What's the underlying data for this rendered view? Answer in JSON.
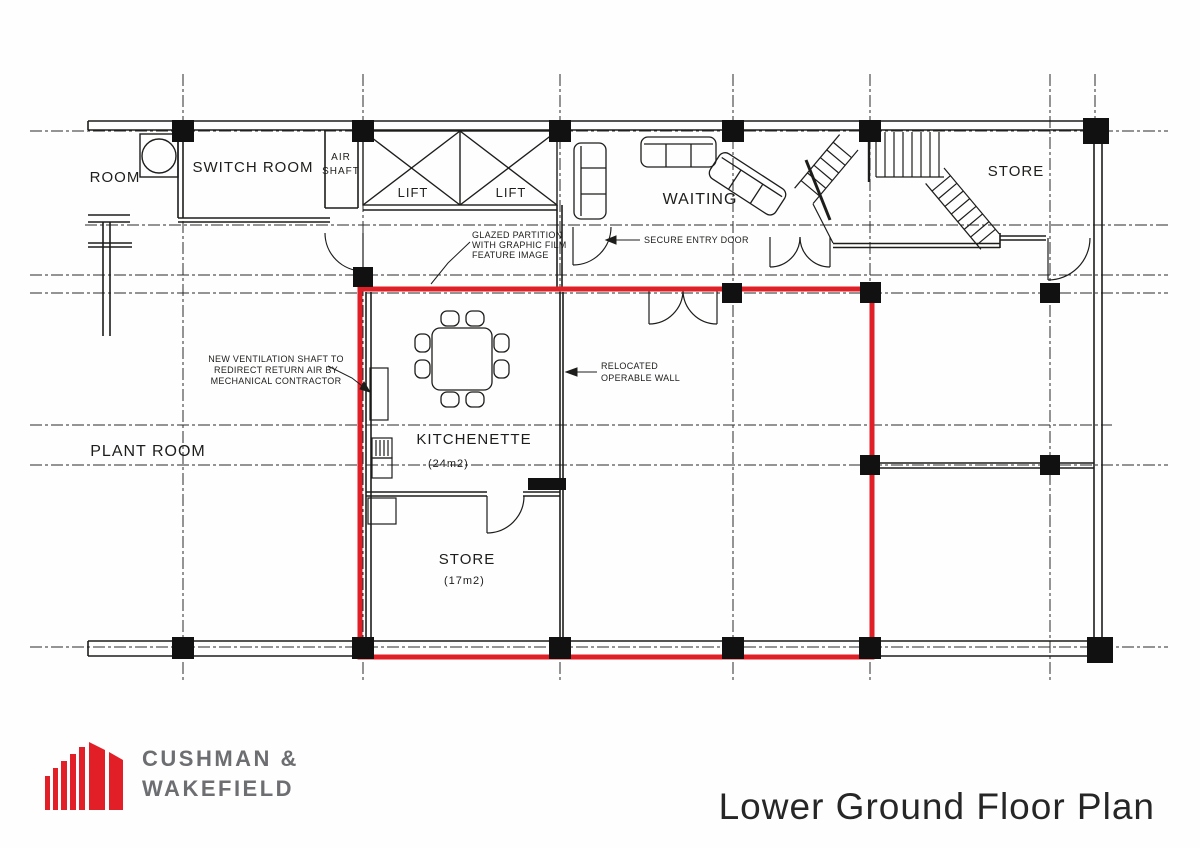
{
  "colors": {
    "highlight_red": "#e01f26",
    "logo_red": "#e21f26",
    "logo_gray": "#6d6e71",
    "ink": "#1d1d1b"
  },
  "plan": {
    "labels": {
      "room": "ROOM",
      "switch_room": "SWITCH ROOM",
      "air1": "AIR",
      "air2": "SHAFT",
      "lift_left": "LIFT",
      "lift_right": "LIFT",
      "waiting": "WAITING",
      "store_upper": "STORE",
      "plant_room": "PLANT ROOM",
      "kitchenette": "KITCHENETTE",
      "kitchenette_area": "(24m2)",
      "store_lower": "STORE",
      "store_lower_area": "(17m2)"
    },
    "annotations": {
      "glazed1": "GLAZED PARTITION",
      "glazed2": "WITH GRAPHIC FILM",
      "glazed3": "FEATURE IMAGE",
      "secure": "SECURE ENTRY DOOR",
      "vent1": "NEW VENTILATION SHAFT TO",
      "vent2": "REDIRECT RETURN AIR BY",
      "vent3": "MECHANICAL CONTRACTOR",
      "wall1": "RELOCATED",
      "wall2": "OPERABLE WALL"
    }
  },
  "footer": {
    "logo_line1": "CUSHMAN &",
    "logo_line2": "WAKEFIELD",
    "title": "Lower Ground Floor Plan"
  }
}
